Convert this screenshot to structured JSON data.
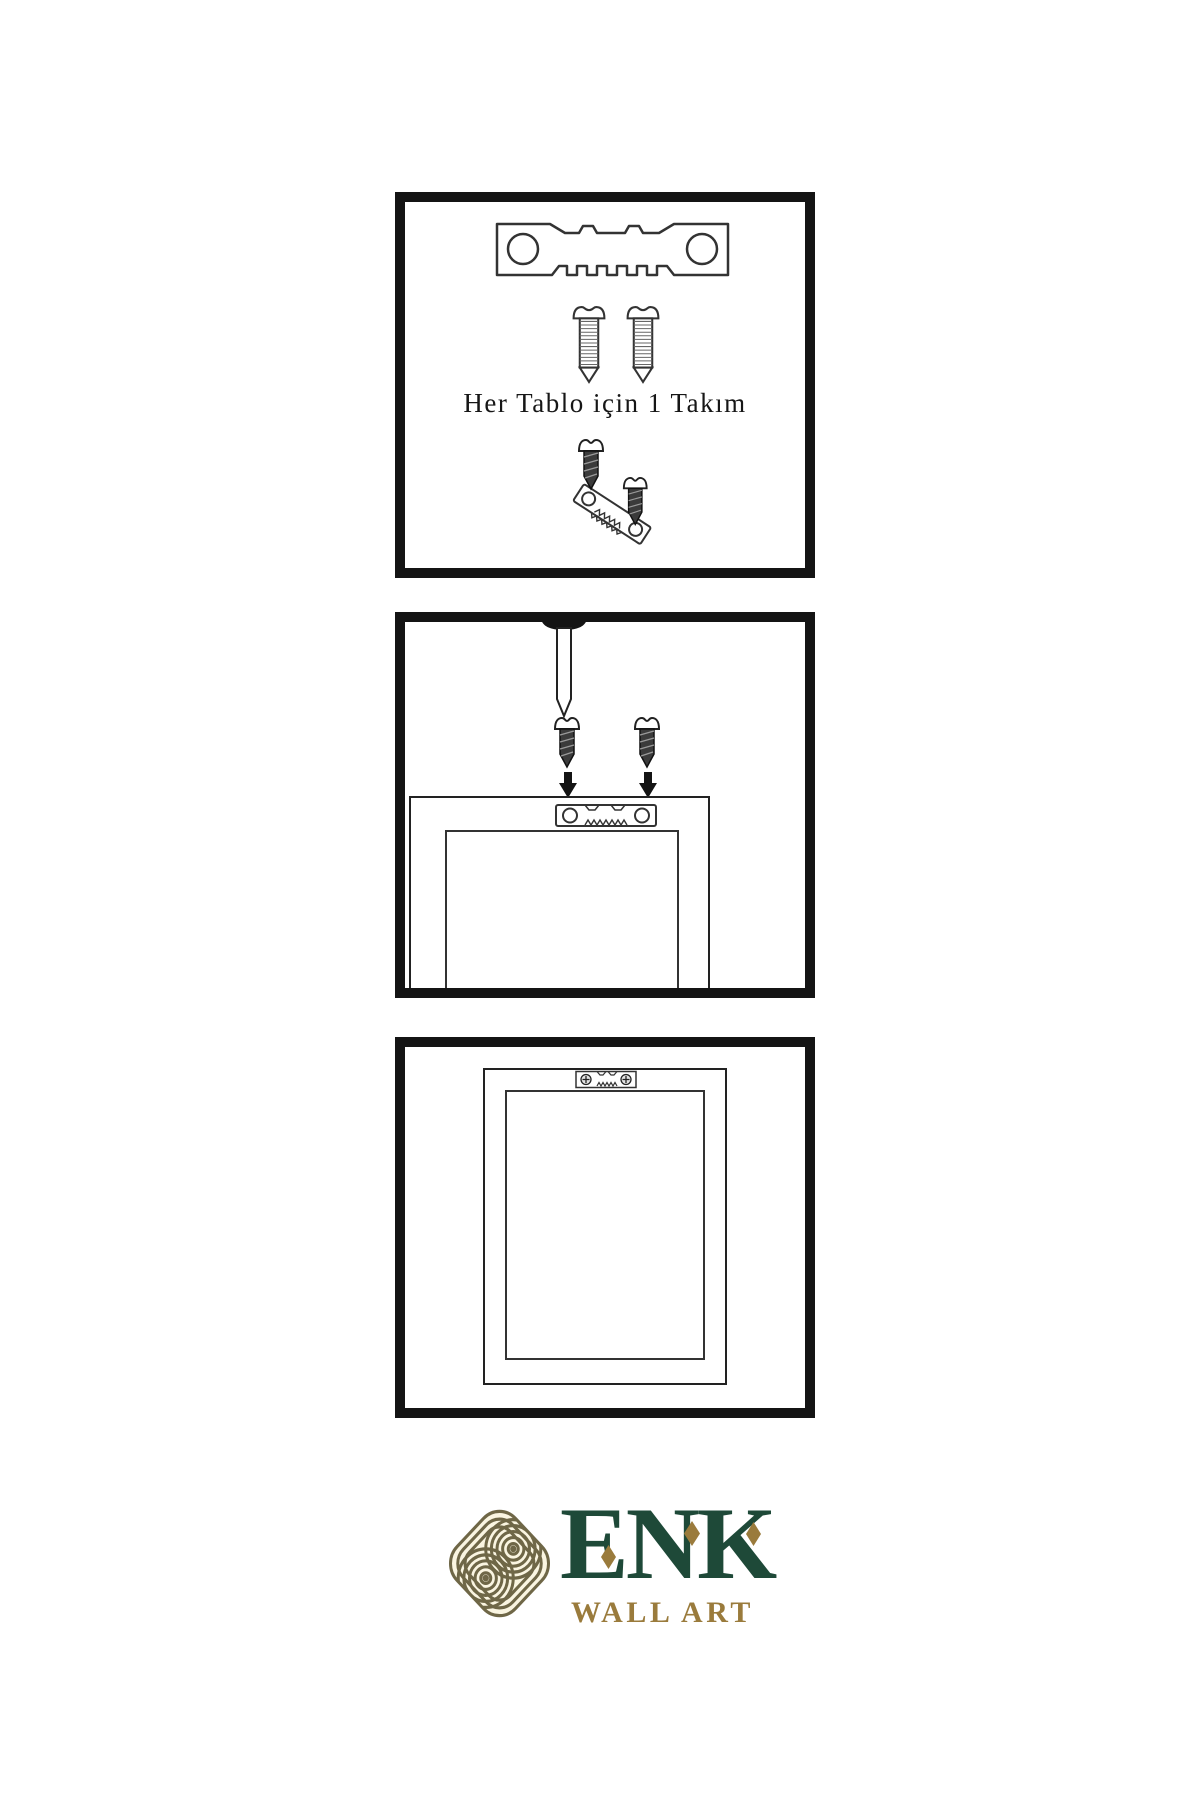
{
  "page": {
    "background": "#ffffff",
    "language": "tr",
    "kind": "wall-art-hanging-instructions"
  },
  "instructions": {
    "steps": [
      {
        "name": "hardware-kit",
        "caption": "Her Tablo için 1 Takım",
        "icons": [
          "sawtooth-hanger-icon",
          "screw-icon",
          "screw-icon",
          "hanger-mounting-assembly-icon"
        ]
      },
      {
        "name": "mount-hanger-on-frame-back",
        "icons": [
          "wall-nail-icon",
          "dark-screw-icon",
          "dark-screw-icon",
          "down-arrow-icon",
          "down-arrow-icon",
          "frame-back-with-sawtooth-hanger-icon"
        ]
      },
      {
        "name": "hang-frame-on-wall",
        "icons": [
          "mounted-frame-with-hanger-icon"
        ]
      }
    ]
  },
  "logo": {
    "brand": "ENK",
    "tagline": "WALL ART",
    "icon": "interlocking-knot-icon",
    "colors": {
      "brand_green": "#1e4938",
      "brand_gold": "#9a7b3c",
      "knot_line": "#6f6747",
      "knot_background": "#faf5e1"
    }
  },
  "artwork": {
    "line_color": "#222222",
    "panel_border_color": "#141414",
    "fill_color": "#ffffff",
    "dark_fill": "#3b3b3b"
  }
}
